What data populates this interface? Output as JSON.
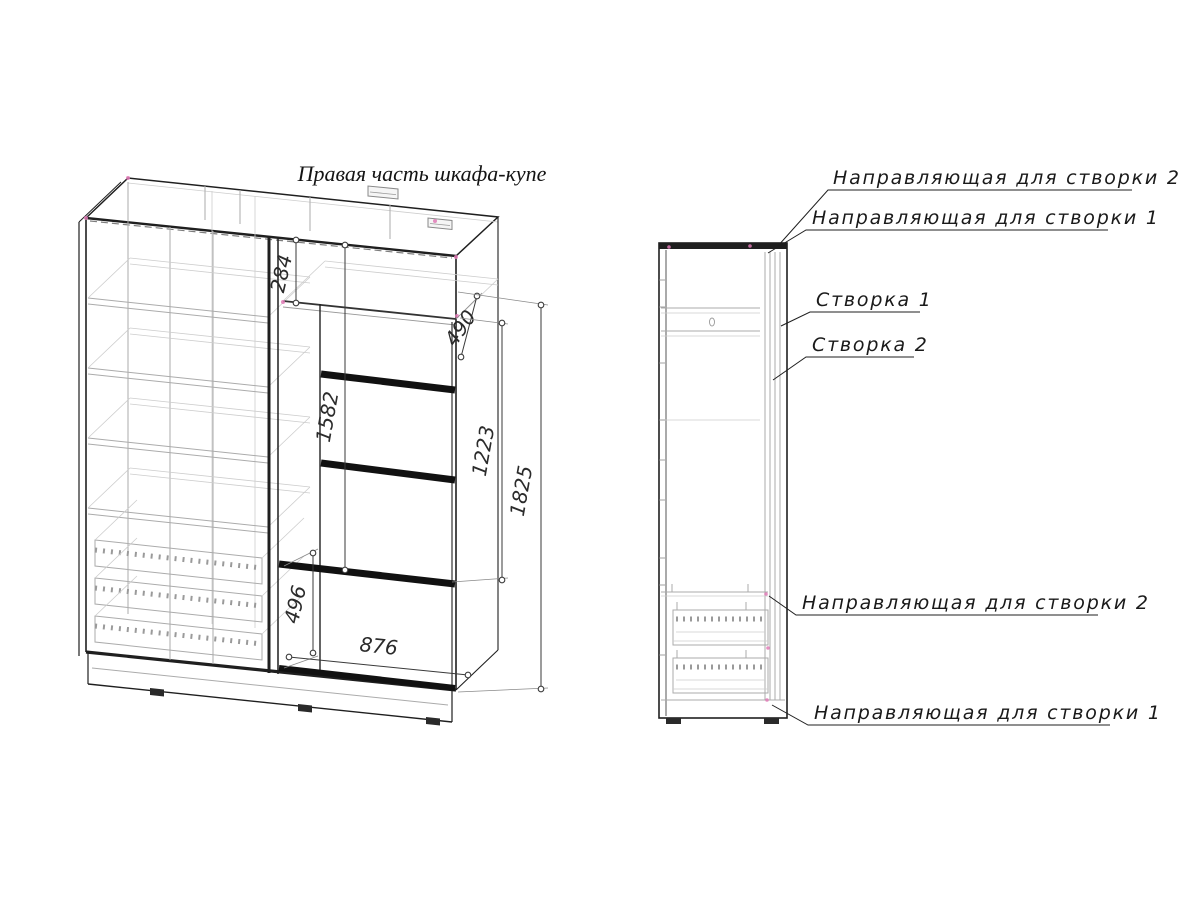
{
  "title": "Правая часть шкафа-купе",
  "main_view": {
    "dimensions": {
      "d284": "284",
      "d490": "490",
      "d1582": "1582",
      "d1223": "1223",
      "d1825": "1825",
      "d496": "496",
      "d876": "876"
    }
  },
  "side_view": {
    "callouts": {
      "rail2_top": "Направляющая для створки 2",
      "rail1_top": "Направляющая для створки 1",
      "door1": "Створка 1",
      "door2": "Створка 2",
      "rail2_bottom": "Направляющая для створки 2",
      "rail1_bottom": "Направляющая для створки 1"
    }
  },
  "colors": {
    "ink": "#1f1f1f",
    "light_gray": "#b8b8b8",
    "accent_pink": "#e07ab6"
  }
}
